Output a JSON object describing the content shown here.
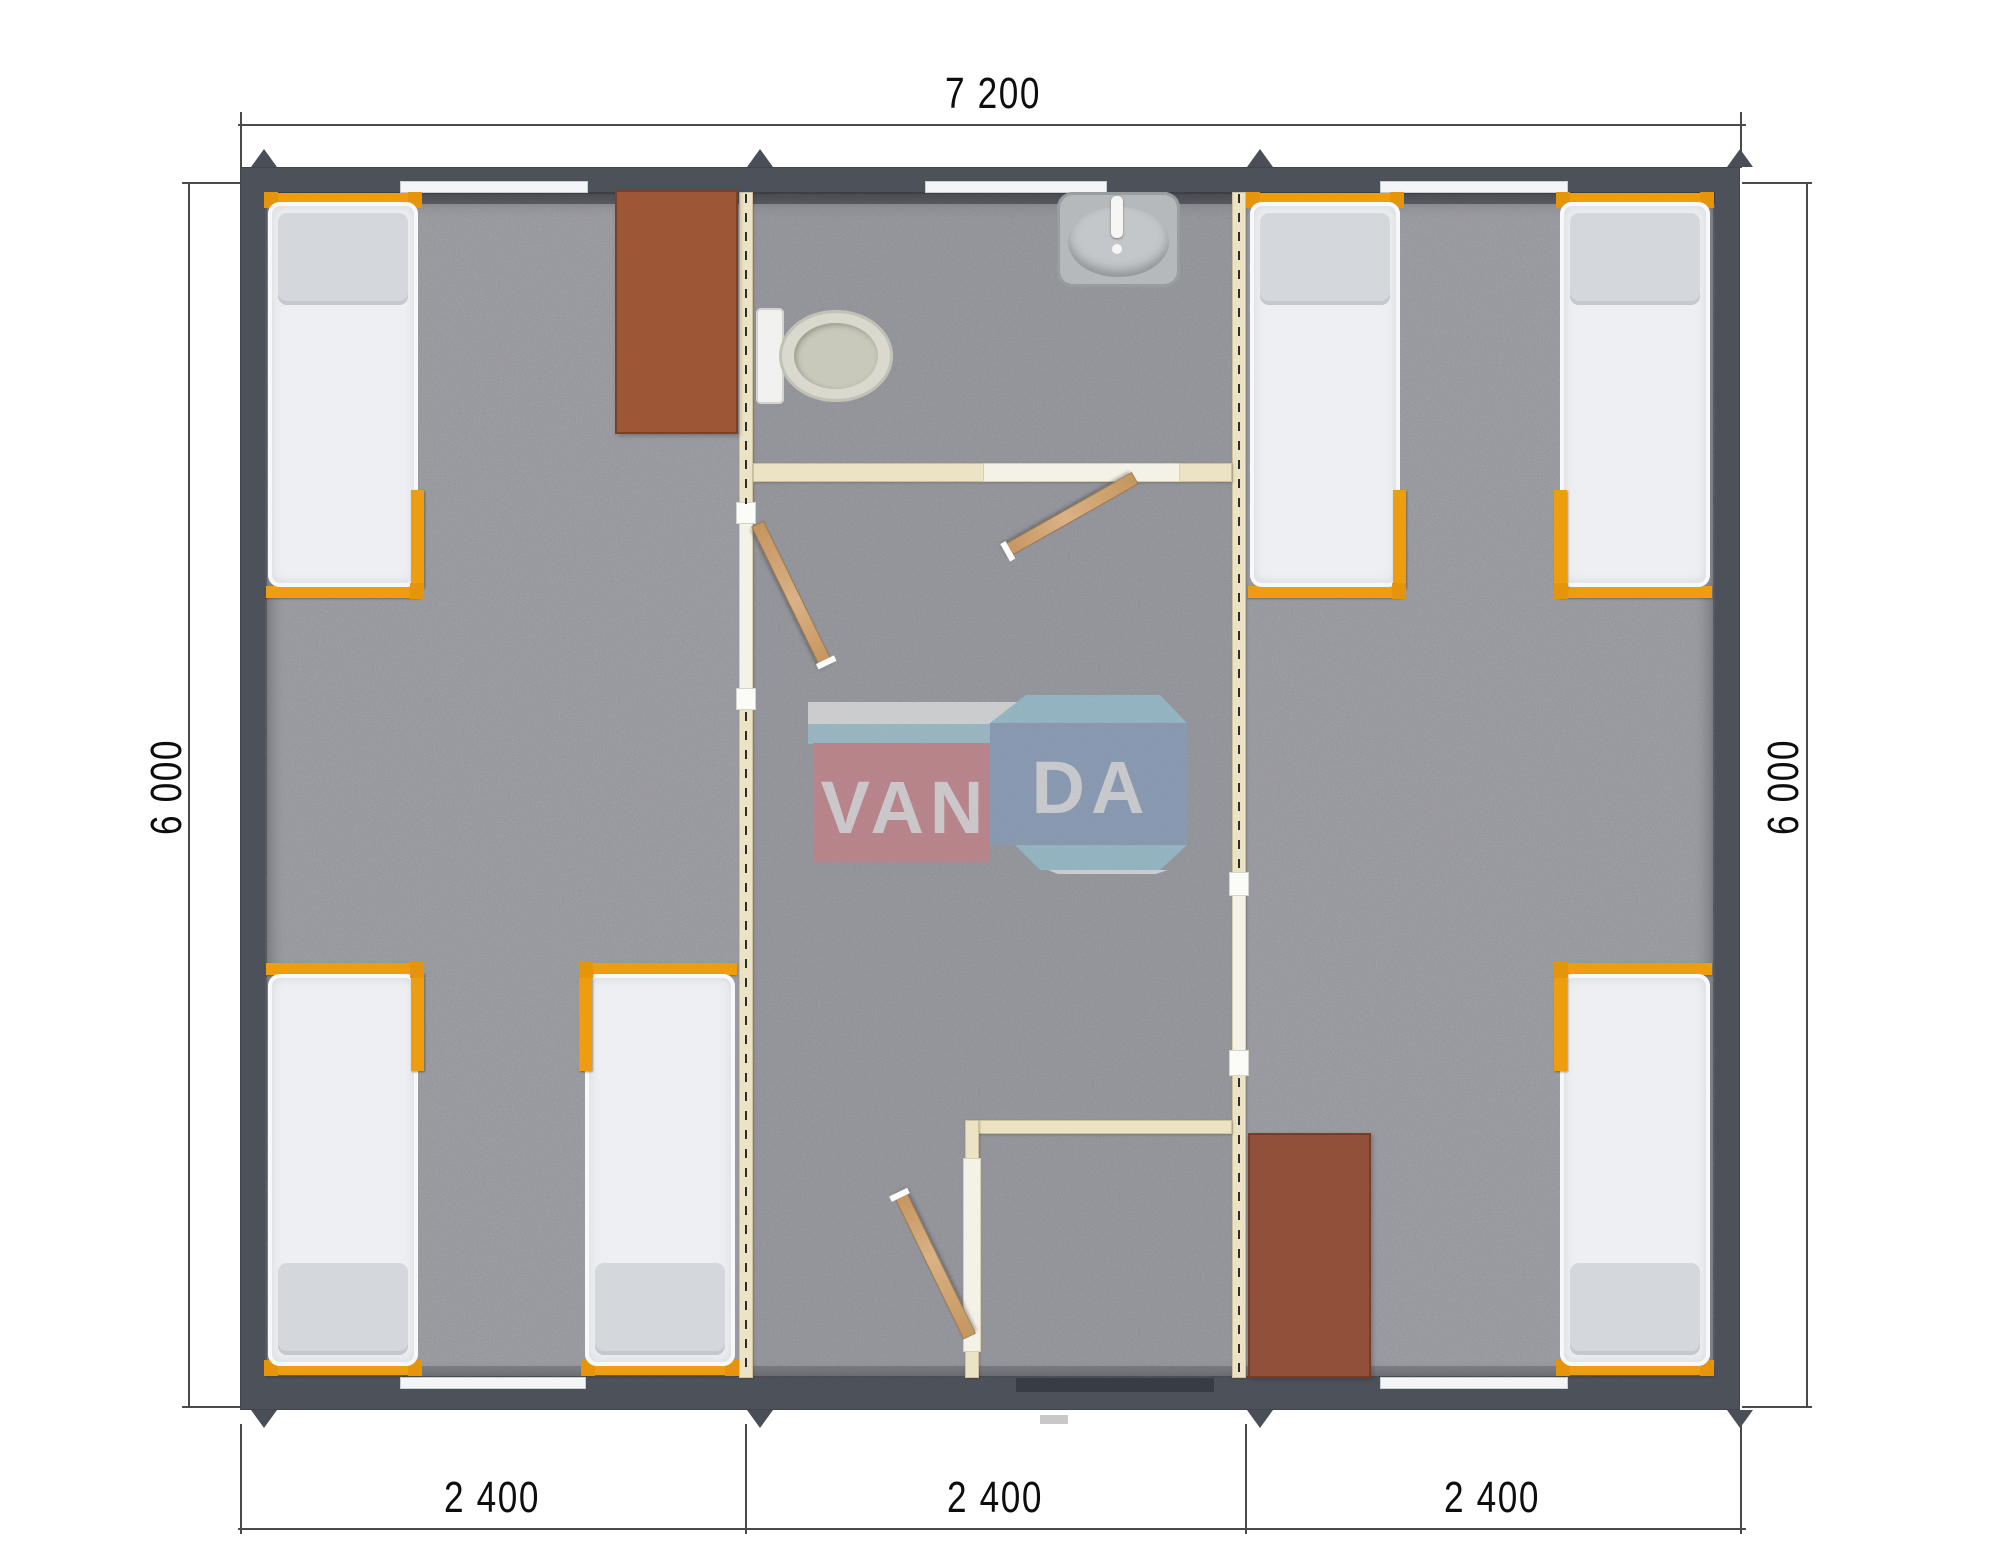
{
  "title": "VANDA modular cabin floor plan",
  "dimensions": {
    "top": "7 200",
    "left": "6 000",
    "right": "6 000",
    "bottom": [
      "2 400",
      "2 400",
      "2 400"
    ]
  },
  "watermark": {
    "name": "VANDA",
    "left": "VAN",
    "right": "DA"
  },
  "colors": {
    "wall": "#4d515a",
    "floor": "#abacb0",
    "partition": "#ebe3c3",
    "bed_frame_orange": "#ee9d0e",
    "mattress": "#edeff2",
    "pillow": "#d4d7dc",
    "table_brown": "#9d5736",
    "table_brown_dark": "#91503a",
    "door_wood": "#cda271",
    "window_white": "#f3f5f6",
    "logo_red": "#d9767e",
    "logo_blue": "#7e9dc4",
    "logo_lightblue": "#93d0e2",
    "dimension_text": "#0d0d0d"
  },
  "plan": {
    "origin": {
      "x": 240,
      "y": 167,
      "w": 1500,
      "h": 1243
    },
    "floor": {
      "x": 25,
      "y": 25,
      "w": 1450,
      "h": 1186
    },
    "corridor_tint": {
      "x": 513,
      "y": 25,
      "w": 479,
      "h": 1186
    },
    "cream_walls": [
      {
        "name": "partition-left-wall",
        "x": 499,
        "y": 25,
        "w": 14,
        "h": 1186
      },
      {
        "name": "partition-right-wall",
        "x": 992,
        "y": 25,
        "w": 14,
        "h": 1186
      },
      {
        "name": "bathroom-wall",
        "x": 513,
        "y": 296,
        "w": 479,
        "h": 19
      },
      {
        "name": "shower-wall-top",
        "x": 725,
        "y": 953,
        "w": 267,
        "h": 14
      },
      {
        "name": "shower-wall-left",
        "x": 725,
        "y": 953,
        "w": 14,
        "h": 258
      }
    ],
    "light_sections": [
      {
        "name": "left-room-doorway",
        "x": 499,
        "y": 339,
        "w": 14,
        "h": 204
      },
      {
        "name": "right-room-doorway",
        "x": 992,
        "y": 709,
        "w": 14,
        "h": 176
      },
      {
        "name": "bathroom-door-opening",
        "x": 743,
        "y": 296,
        "w": 197,
        "h": 19
      },
      {
        "name": "shower-door-panel",
        "x": 723,
        "y": 991,
        "w": 18,
        "h": 194
      }
    ],
    "jambs": [
      {
        "x": 496,
        "y": 335,
        "w": 20,
        "h": 22
      },
      {
        "x": 496,
        "y": 521,
        "w": 20,
        "h": 22
      },
      {
        "x": 989,
        "y": 705,
        "w": 20,
        "h": 24
      },
      {
        "x": 989,
        "y": 883,
        "w": 20,
        "h": 26
      }
    ],
    "dashes": [
      {
        "x": 505,
        "y": 27,
        "h": 310
      },
      {
        "x": 505,
        "y": 545,
        "h": 664
      },
      {
        "x": 998,
        "y": 27,
        "h": 680
      },
      {
        "x": 998,
        "y": 911,
        "h": 298
      }
    ],
    "windows": [
      {
        "name": "window-top-left",
        "x": 160,
        "y": 14,
        "w": 188,
        "h": 12
      },
      {
        "name": "window-top-middle",
        "x": 685,
        "y": 14,
        "w": 182,
        "h": 12
      },
      {
        "name": "window-top-right",
        "x": 1140,
        "y": 14,
        "w": 188,
        "h": 12
      },
      {
        "name": "window-bottom-left",
        "x": 160,
        "y": 1210,
        "w": 186,
        "h": 12
      },
      {
        "name": "window-bottom-right",
        "x": 1140,
        "y": 1210,
        "w": 188,
        "h": 12
      }
    ],
    "entry": {
      "x": 776,
      "y": 1211,
      "w": 198,
      "h": 14
    },
    "step": {
      "x": 800,
      "y": 1248,
      "w": 28,
      "h": 9
    },
    "beds": [
      {
        "name": "bed-1",
        "x": 26,
        "y": 26,
        "h": 405,
        "head": "top",
        "bracket": "right"
      },
      {
        "name": "bed-2",
        "x": 26,
        "y": 796,
        "h": 412,
        "head": "bottom",
        "bracket": "right"
      },
      {
        "name": "bed-3",
        "x": 343,
        "y": 796,
        "h": 412,
        "head": "bottom",
        "bracket": "left"
      },
      {
        "name": "bed-4",
        "x": 1008,
        "y": 26,
        "h": 405,
        "head": "top",
        "bracket": "right"
      },
      {
        "name": "bed-5",
        "x": 1318,
        "y": 26,
        "h": 405,
        "head": "top",
        "bracket": "left"
      },
      {
        "name": "bed-6",
        "x": 1318,
        "y": 796,
        "h": 412,
        "head": "bottom",
        "bracket": "left"
      }
    ],
    "tables": [
      {
        "name": "table-top-left",
        "x": 375,
        "y": 23,
        "w": 123,
        "h": 244,
        "color": "#9d5736"
      },
      {
        "name": "table-bottom-right",
        "x": 1008,
        "y": 966,
        "w": 123,
        "h": 245,
        "color": "#91503a"
      }
    ],
    "doors": [
      {
        "name": "bathroom-door-leaf",
        "x": 884,
        "y": 313,
        "len": 146,
        "angle": 150.5
      },
      {
        "name": "left-room-door-leaf",
        "x": 514,
        "y": 361,
        "len": 154,
        "angle": 64
      },
      {
        "name": "shower-door-leaf",
        "x": 721,
        "y": 1163,
        "len": 157,
        "angle": -116
      }
    ],
    "toilet": {
      "tank": {
        "x": 516,
        "y": 141,
        "w": 28,
        "h": 96
      },
      "bowl": {
        "x": 539,
        "y": 143,
        "w": 114,
        "h": 92
      },
      "inner": {
        "x": 554,
        "y": 156,
        "w": 84,
        "h": 66
      }
    },
    "sink": {
      "body": {
        "x": 817,
        "y": 25,
        "w": 123,
        "h": 95
      },
      "basin": {
        "x": 828,
        "y": 40,
        "w": 101,
        "h": 70
      },
      "faucet": {
        "x": 871,
        "y": 29,
        "w": 12,
        "h": 42
      },
      "knob": {
        "x": 872,
        "y": 77,
        "w": 10,
        "h": 10
      }
    },
    "roof_peaks": {
      "xs": [
        12,
        508,
        1008,
        1488
      ]
    }
  }
}
